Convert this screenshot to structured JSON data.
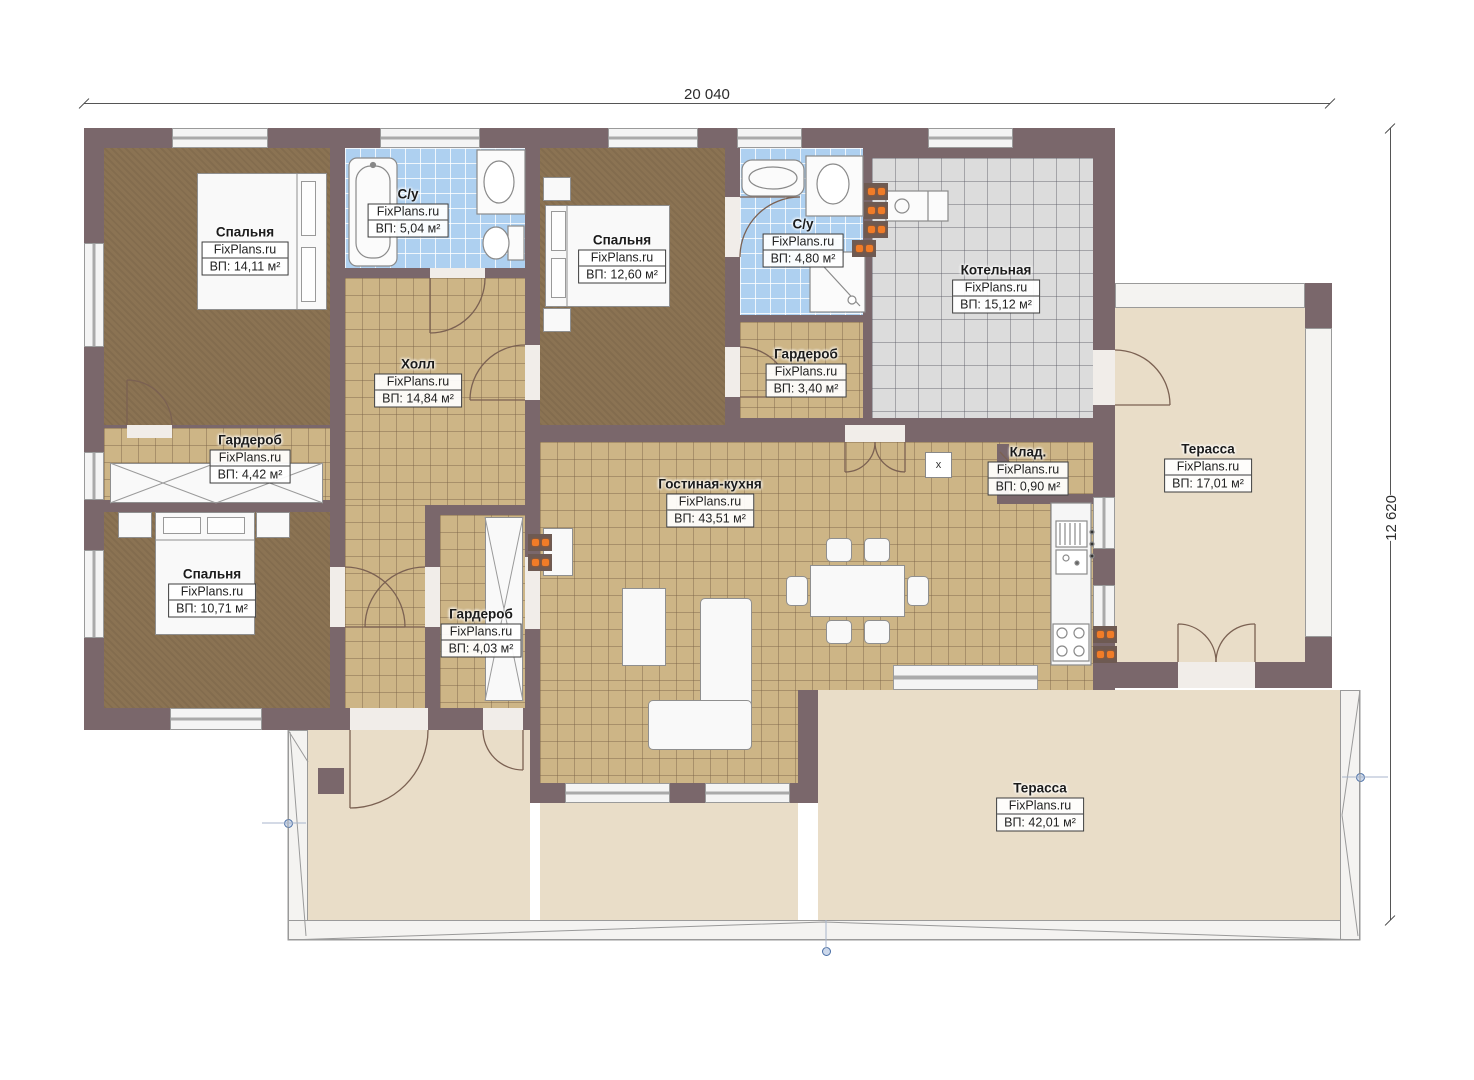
{
  "watermark": "FixPlans.ru",
  "dimensions": {
    "width_label": "20 040",
    "height_label": "12 620"
  },
  "misc": {
    "niche_label": "x"
  },
  "rooms": [
    {
      "name": "Спальня",
      "area": "ВП: 14,11 м²"
    },
    {
      "name": "С/у",
      "area": "ВП: 5,04 м²"
    },
    {
      "name": "Холл",
      "area": "ВП: 14,84 м²"
    },
    {
      "name": "Спальня",
      "area": "ВП: 12,60 м²"
    },
    {
      "name": "С/у",
      "area": "ВП: 4,80 м²"
    },
    {
      "name": "Котельная",
      "area": "ВП: 15,12 м²"
    },
    {
      "name": "Гардероб",
      "area": "ВП: 3,40 м²"
    },
    {
      "name": "Гардероб",
      "area": "ВП: 4,42 м²"
    },
    {
      "name": "Спальня",
      "area": "ВП: 10,71 м²"
    },
    {
      "name": "Гардероб",
      "area": "ВП: 4,03 м²"
    },
    {
      "name": "Гостиная-кухня",
      "area": "ВП: 43,51 м²"
    },
    {
      "name": "Клад.",
      "area": "ВП: 0,90 м²"
    },
    {
      "name": "Терасса",
      "area": "ВП: 17,01 м²"
    },
    {
      "name": "Терасса",
      "area": "ВП: 42,01 м²"
    }
  ]
}
